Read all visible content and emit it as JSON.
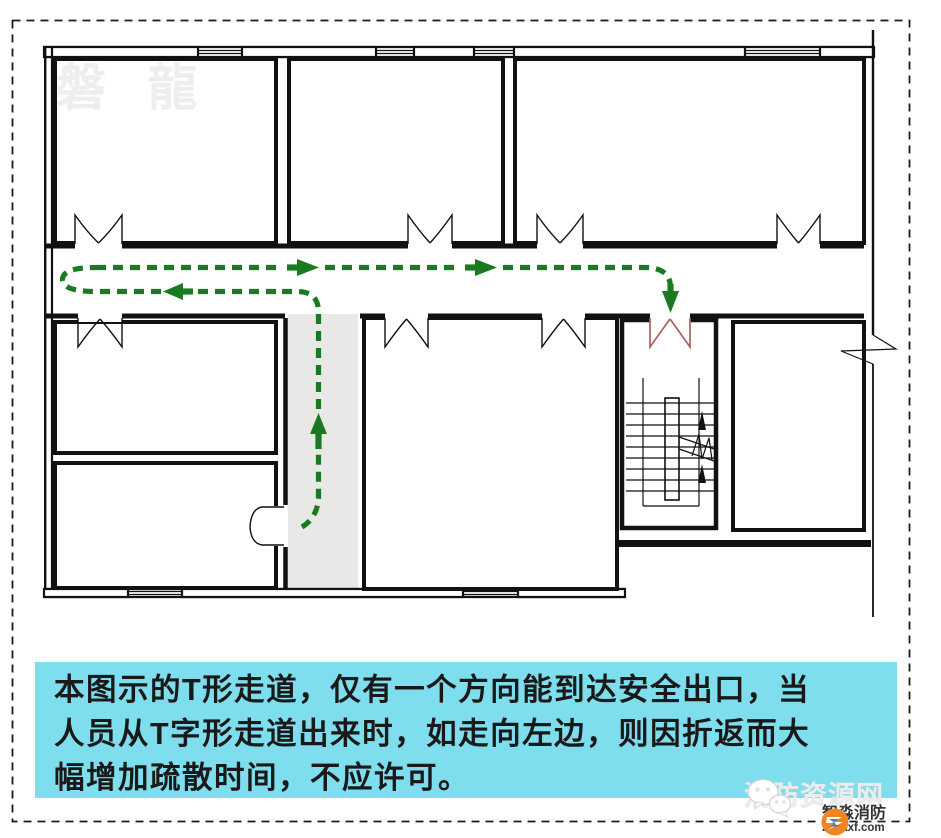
{
  "canvas": {
    "width": 941,
    "height": 838
  },
  "colors": {
    "wall": "#111111",
    "canvas_border": "#1a1a1a",
    "route_green": "#1a7a21",
    "exit_door_red": "#a96060",
    "corridor_gray": "#e8e8e6",
    "caption_bg": "#7edeee",
    "caption_text": "#191919",
    "watermark_gray": "#f0edee",
    "site_watermark": "#ececec",
    "brand_orange": "#f08423",
    "brand_text": "#333333"
  },
  "caption": {
    "lines": [
      "本图示的T形走道，仅有一个方向能到达安全出口，当",
      "人员从T字形走道出来时，如走向左边，则因折返而大",
      "幅增加疏散时间，不应许可。"
    ]
  },
  "watermarks": {
    "top_left": "磐 龍",
    "site_name": "消防资源网",
    "brand_name": "智淼消防",
    "brand_domain": "zmjaxf.com"
  }
}
